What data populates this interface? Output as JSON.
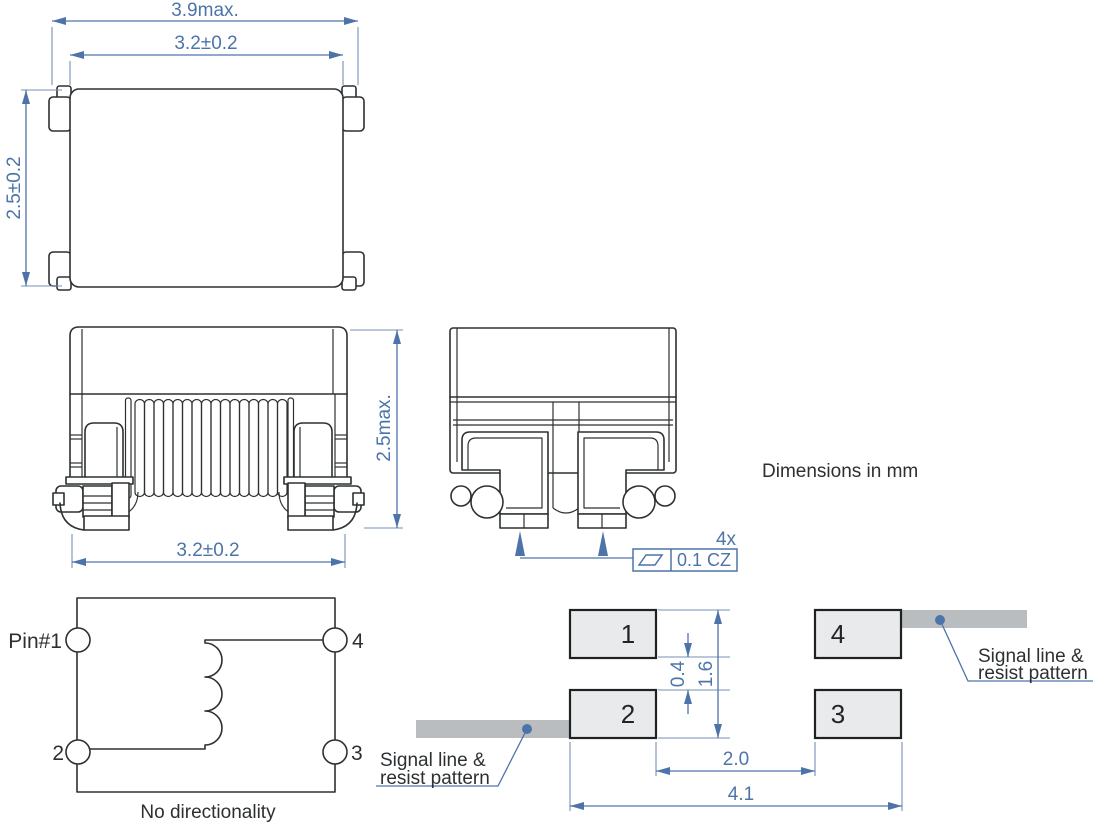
{
  "colors": {
    "dimension_blue": "#4d74a9",
    "line_art": "#2d3032",
    "pad_fill": "#e9eaeb",
    "trace_gray": "#b9bdc0",
    "background": "#ffffff"
  },
  "notes": {
    "units": "Dimensions in mm"
  },
  "top_view": {
    "dim_overall_width": "3.9max.",
    "dim_body_width": "3.2±0.2",
    "dim_body_height": "2.5±0.2"
  },
  "front_view": {
    "dim_height": "2.5max.",
    "dim_width": "3.2±0.2"
  },
  "side_view": {
    "qty": "4x",
    "tolerance": "0.1 CZ"
  },
  "schematic": {
    "pin1": "Pin#1",
    "pin2": "2",
    "pin3": "3",
    "pin4": "4",
    "note": "No directionality"
  },
  "land_pattern": {
    "pad1": "1",
    "pad2": "2",
    "pad3": "3",
    "pad4": "4",
    "dim_pad_gap": "0.4",
    "dim_pad_span": "1.6",
    "dim_inner_span": "2.0",
    "dim_outer_span": "4.1",
    "callout_left_line1": "Signal line &",
    "callout_left_line2": "resist pattern",
    "callout_right_line1": "Signal line &",
    "callout_right_line2": "resist pattern"
  }
}
